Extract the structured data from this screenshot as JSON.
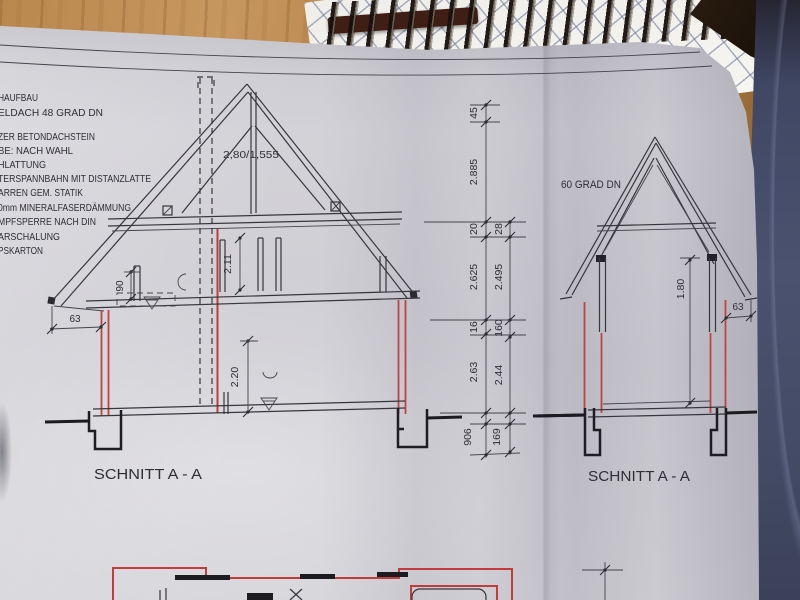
{
  "notes": {
    "lines": [
      "HAUFBAU",
      "ELDACH 48 GRAD DN",
      "ZER BETONDACHSTEIN",
      "BE: NACH WAHL",
      "HLATTUNG",
      "TERSPANNBAHN MIT DISTANZLATTE",
      "ARREN GEM. STATIK",
      "0mm MINERALFASERDÄMMUNG",
      "MPFSPERRE NACH DIN",
      "ARSCHALUNG",
      "PSKARTON"
    ]
  },
  "left_section": {
    "title": "SCHNITT A - A",
    "truss_dim": "2,80/1,555",
    "dim_knee_wall": "90",
    "dim_attic_room_height": "2.11",
    "dim_ground_room_height": "2.20",
    "dim_eave_overhang": "63"
  },
  "dim_chains": {
    "left": [
      "45",
      "2.885",
      "20",
      "2.625",
      "16",
      "2.63",
      "906"
    ],
    "right": [
      "28",
      "2.495",
      "160",
      "2.44",
      "169"
    ]
  },
  "right_section": {
    "title": "SCHNITT A - A",
    "roof_pitch_label": "60 GRAD DN",
    "dim_room_height": "1.80",
    "dim_eave_overhang": "63"
  }
}
